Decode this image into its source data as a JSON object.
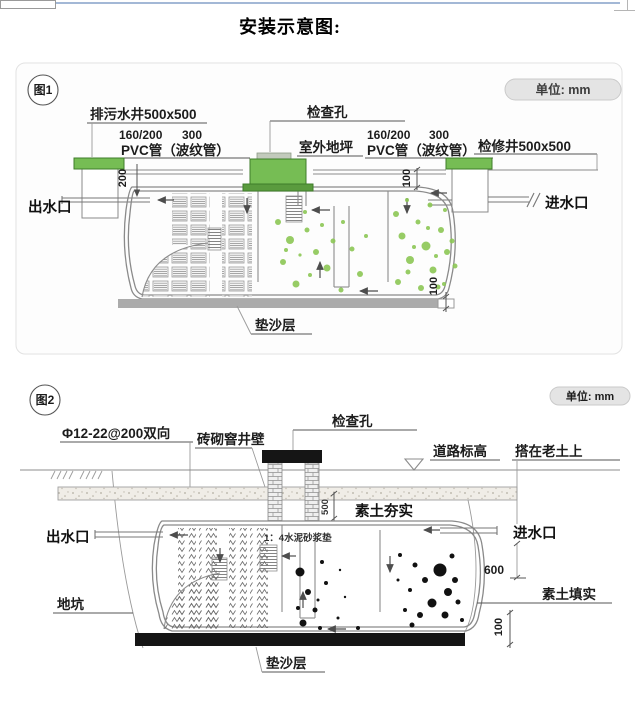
{
  "title": "安装示意图:",
  "fig1": {
    "badge": "图1",
    "unit": "单位: mm",
    "sewage_well": "排污水井500x500",
    "pvc_left_dim1": "160/200",
    "pvc_left_dim2": "300",
    "pvc_left": "PVC管（波纹管）",
    "inspection_hole": "检查孔",
    "outdoor_ground": "室外地坪",
    "pvc_right_dim1": "160/200",
    "pvc_right_dim2": "300",
    "pvc_right": "PVC管（波纹管）",
    "access_well": "检修井500x500",
    "outlet": "出水口",
    "inlet": "进水口",
    "sand_layer": "垫沙层",
    "dim_200": "200",
    "dim_100_top": "100",
    "dim_100_bottom": "100"
  },
  "fig2": {
    "badge": "图2",
    "unit": "单位: mm",
    "rebar": "Φ12-22@200双向",
    "brick_wall": "砖砌窨井壁",
    "inspection_hole": "检查孔",
    "road_level": "道路标高",
    "on_old_soil": "搭在老土上",
    "compacted_soil": "素土夯实",
    "mortar_pad": "1：4水泥砂浆垫",
    "outlet": "出水口",
    "inlet": "进水口",
    "dim_500": "500",
    "dim_600": "600",
    "soil_fill": "素土填实",
    "pit": "地坑",
    "sand_layer": "垫沙层",
    "dim_100": "100"
  },
  "colors": {
    "cap_green": "#76bd54",
    "cap_green_dark": "#5a9b3e",
    "bubble_green": "#8cc755",
    "base_gray": "#ababab",
    "base_black": "#151515",
    "accent_line_blue": "#a3b8d6"
  }
}
